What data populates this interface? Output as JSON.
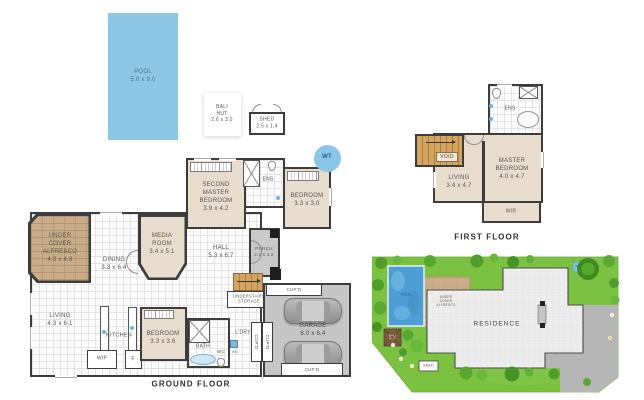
{
  "colors": {
    "wall": "#3c3c3c",
    "room_fill": "#e8dccd",
    "tile_floor": "#fdfdfd",
    "paver_tan": "#c9ad8a",
    "pool_blue": "#8ec7e6",
    "site_pool_blue": "#4d9ed6",
    "water_tank_blue": "#8ac6e8",
    "garage_gray": "#c6c6c6",
    "porch_gray": "#c9c9c9",
    "stair_wood": "#cf9a50",
    "lawn_green": "#7cc242",
    "tree_green": "#4f9e2b",
    "driveway_gray": "#b6b6b6"
  },
  "outbuildings": {
    "pool": "POOL\n5.0 x 9.0",
    "bali_hut": "BALI\nHUT\n2.6 x 3.0",
    "shed": "SHED\n2.5 x 1.4"
  },
  "ground_floor": {
    "title": "GROUND FLOOR",
    "alfresco": "UNDER\nCOVER\nALFRESCO\n4.3 x 4.8",
    "dining": "DINING\n3.3 x 6.4",
    "media_room": "MEDIA\nROOM\n3.4 x 5.1",
    "second_master": "SECOND\nMASTER\nBEDROOM\n3.9 x 4.2",
    "ens": "ENS",
    "bedroom_rear": "BEDROOM\n3.3 x 3.0",
    "hall": "HALL\n5.3 x 6.7",
    "porch": "PORCH\n2.2 x 4.2",
    "living": "LIVING\n4.3 x 6.1",
    "kitchen": "KITCHEN",
    "wip": "WIP",
    "fridge": "F",
    "bedroom_front": "BEDROOM\n3.3 x 3.6",
    "bath": "BATH",
    "wc": "WC",
    "wm": "WM",
    "laundry": "L'DRY",
    "understairs": "UNDERSTAIRS\nSTORAGE",
    "cupboard_top": "CUP'D",
    "cupboard_left": "CUP'D",
    "cupboard_right": "CUP'D",
    "cupboard_bottom": "CUP'D",
    "garage": "GARAGE\n6.0 x 6.4",
    "water_tank": "WT"
  },
  "first_floor": {
    "title": "FIRST FLOOR",
    "ens": "ENS",
    "void": "VOID",
    "living": "LIVING\n3.4 x 4.7",
    "master_bedroom": "MASTER\nBEDROOM\n4.0 x 4.7",
    "wir": "WIR"
  },
  "site_plan": {
    "pool": "POOL",
    "alfresco": "UNDER\nCOVER\nALFRESCO",
    "bali_hut": "BALI\nHUT",
    "residence": "RESIDENCE",
    "shed": "SHED",
    "water_tank": "WT"
  }
}
